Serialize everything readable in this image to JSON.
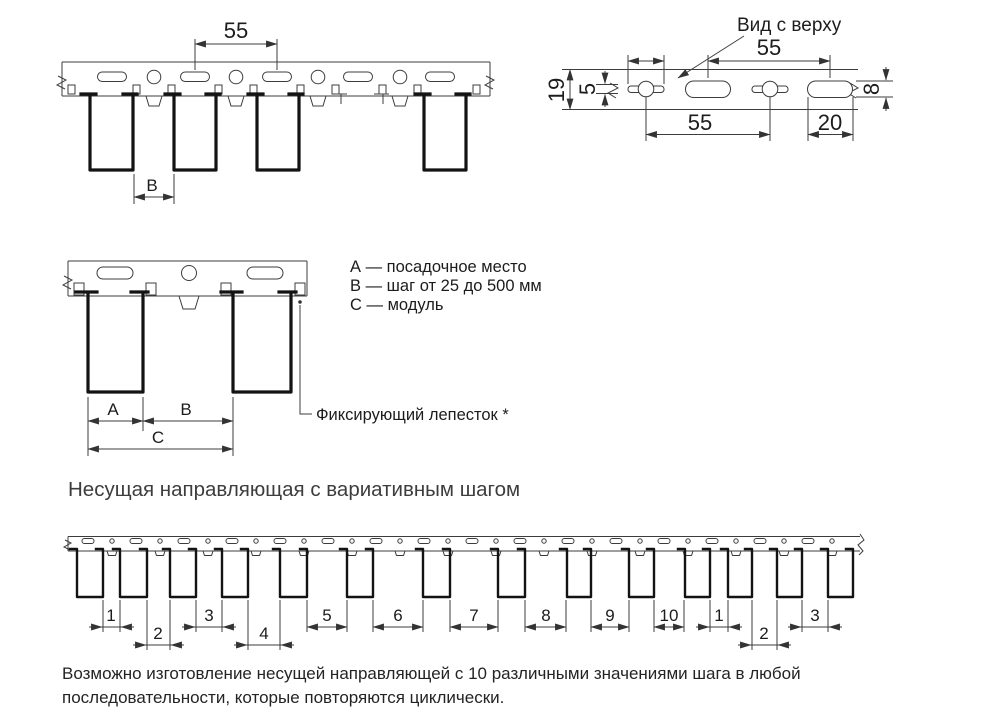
{
  "front_view": {
    "dim_55": "55",
    "dim_b": "В"
  },
  "top_view": {
    "title": "Вид с верху",
    "dim_19": "19",
    "dim_5": "5",
    "dim_55_top": "55",
    "dim_55_bottom": "55",
    "dim_20": "20",
    "dim_8": "8"
  },
  "module_view": {
    "dim_a": "А",
    "dim_b": "В",
    "dim_c": "С",
    "legend": [
      "А — посадочное место",
      "В — шаг от 25 до 500 мм",
      "С — модуль"
    ],
    "fixing_tab_label": "Фиксирующий лепесток *"
  },
  "section_title": "Несущая направляющая с вариативным шагом",
  "variable_view": {
    "step_labels": [
      "1",
      "2",
      "3",
      "4",
      "5",
      "6",
      "7",
      "8",
      "9",
      "10",
      "1",
      "2",
      "3"
    ]
  },
  "footer": {
    "lines": [
      "Возможно изготовление несущей направляющей с 10 различными значениями шага в любой",
      "последовательности, которые повторяются циклически."
    ]
  }
}
